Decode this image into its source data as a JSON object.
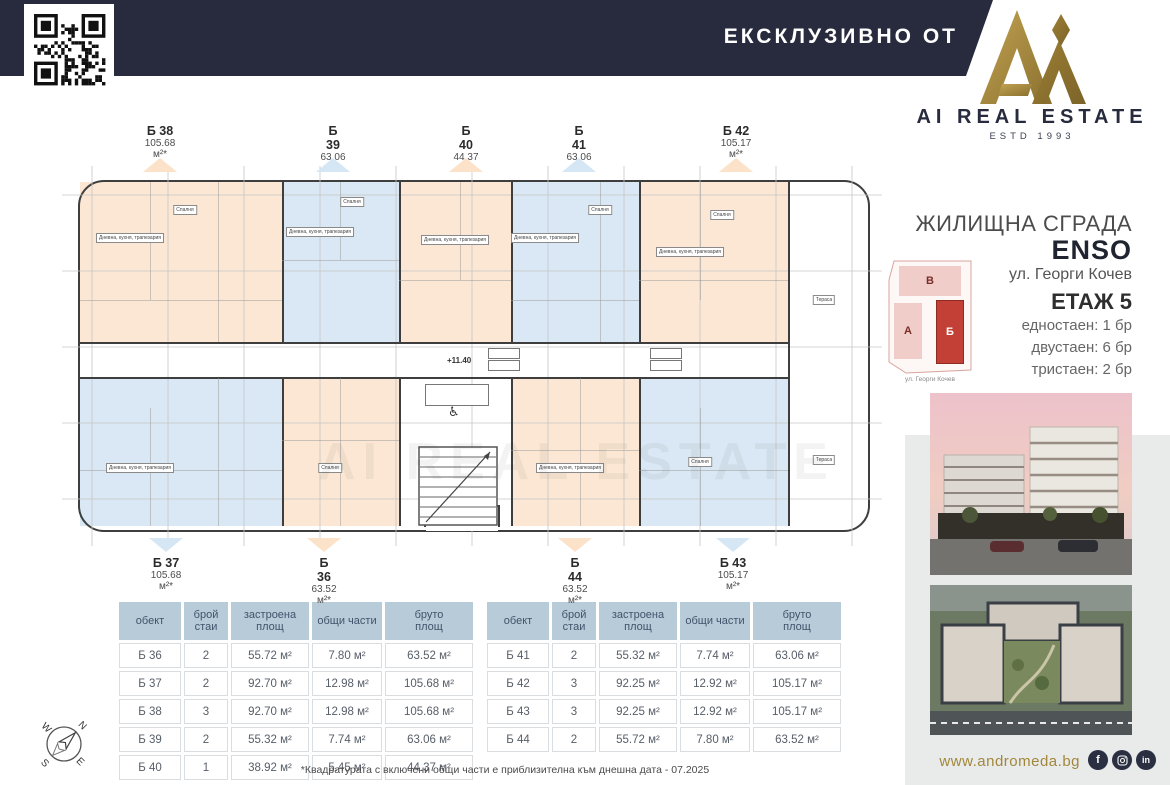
{
  "header": {
    "exclusive_label": "ЕКСКЛУЗИВНО ОТ"
  },
  "brand": {
    "wordmark": "AI REAL ESTATE",
    "estd": "ESTD 1993"
  },
  "project": {
    "type": "ЖИЛИЩНА СГРАДА",
    "name": "ENSO",
    "address": "ул. Георги Кочев"
  },
  "floor": {
    "label": "ЕТАЖ 5",
    "mix": [
      "едностаен: 1 бр",
      "двустаен: 6 бр",
      "тристаен: 2 бр"
    ]
  },
  "site_plan": {
    "blocks": [
      {
        "label": "В",
        "highlight": false
      },
      {
        "label": "А",
        "highlight": false
      },
      {
        "label": "Б",
        "highlight": true
      }
    ],
    "street": "ул. Георги Кочев"
  },
  "plan": {
    "watermark": "AI REAL ESTATE",
    "elevation": "+11.40",
    "units_top": [
      {
        "id": "Б 38",
        "area": "105.68 м²*",
        "fill": "peach"
      },
      {
        "id": "Б 39",
        "area": "63.06 м²*",
        "fill": "blue"
      },
      {
        "id": "Б 40",
        "area": "44.37 м²*",
        "fill": "peach"
      },
      {
        "id": "Б 41",
        "area": "63.06 м²*",
        "fill": "blue"
      },
      {
        "id": "Б 42",
        "area": "105.17 м²*",
        "fill": "peach"
      }
    ],
    "units_bottom": [
      {
        "id": "Б 37",
        "area": "105.68 м²*",
        "fill": "blue"
      },
      {
        "id": "Б 36",
        "area": "63.52 м²*",
        "fill": "peach"
      },
      {
        "id": "Б 44",
        "area": "63.52 м²*",
        "fill": "peach"
      },
      {
        "id": "Б 43",
        "area": "105.17 м²*",
        "fill": "blue"
      }
    ],
    "room_labels": [
      "Дневна, кухня, трапезария",
      "Спалня",
      "Дневна, кухня, трапезария",
      "Спалня",
      "Дневна, кухня, трапезария",
      "Дневна, кухня, трапезария",
      "Спалня",
      "Дневна, кухня, трапезария",
      "Спалня",
      "Дневна, кухня, трапезария",
      "Спалня",
      "Дневна, кухня, трапезария",
      "Спалня",
      "Тераса",
      "Тераса"
    ]
  },
  "tables": {
    "headers": [
      "обект",
      "брой\nстаи",
      "застроена\nплощ",
      "общи части",
      "бруто\nплощ"
    ],
    "left": [
      [
        "Б 36",
        "2",
        "55.72 м²",
        "7.80 м²",
        "63.52 м²"
      ],
      [
        "Б 37",
        "2",
        "92.70 м²",
        "12.98 м²",
        "105.68 м²"
      ],
      [
        "Б 38",
        "3",
        "92.70 м²",
        "12.98 м²",
        "105.68 м²"
      ],
      [
        "Б 39",
        "2",
        "55.32 м²",
        "7.74 м²",
        "63.06 м²"
      ],
      [
        "Б 40",
        "1",
        "38.92 м²",
        "5.45 м²",
        "44.37 м²"
      ]
    ],
    "right": [
      [
        "Б 41",
        "2",
        "55.32 м²",
        "7.74 м²",
        "63.06 м²"
      ],
      [
        "Б 42",
        "3",
        "92.25 м²",
        "12.92 м²",
        "105.17 м²"
      ],
      [
        "Б 43",
        "3",
        "92.25 м²",
        "12.92 м²",
        "105.17 м²"
      ],
      [
        "Б 44",
        "2",
        "55.72 м²",
        "7.80 м²",
        "63.52 м²"
      ]
    ]
  },
  "footnote": "*Квадратурата с включени общи части е приблизителна към днешна дата - 07.2025",
  "footer": {
    "website": "www.andromeda.bg",
    "socials": [
      "facebook",
      "instagram",
      "linkedin"
    ]
  },
  "compass": {
    "n": "N",
    "e": "E",
    "s": "S",
    "w": "W"
  },
  "colors": {
    "navy": "#272b3d",
    "gold": "#a2873b",
    "peach": "#fbe7d3",
    "blue": "#d9e8f4",
    "peach_tri": "#fbe2c9",
    "blue_tri": "#d5e6f5",
    "accent_red": "#c24036",
    "table_header": "#b7cbd8"
  }
}
